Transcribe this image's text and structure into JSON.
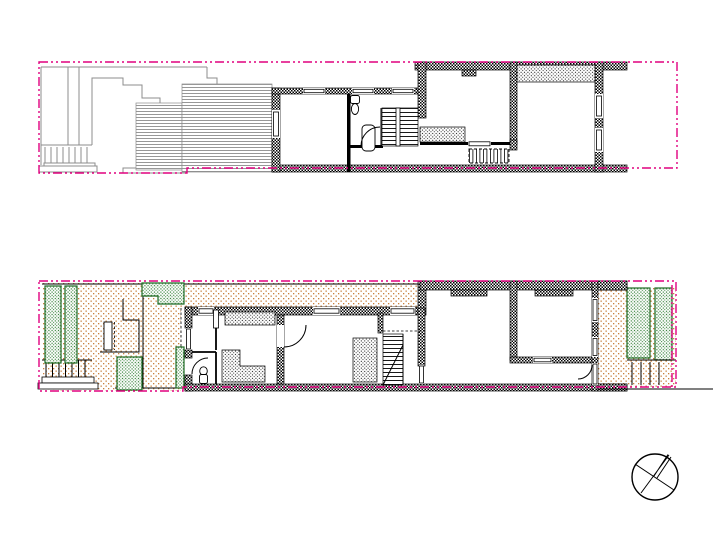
{
  "canvas": {
    "width": 720,
    "height": 540,
    "background": "#ffffff"
  },
  "colors": {
    "boundary": "#e0007f",
    "wall": "#000000",
    "line": "#000000",
    "roof_line": "#8c8c8c",
    "garden": "#c8803c",
    "plant": "#2e7d32",
    "plant_outline": "#1f6b24",
    "paper": "#ffffff"
  }
}
